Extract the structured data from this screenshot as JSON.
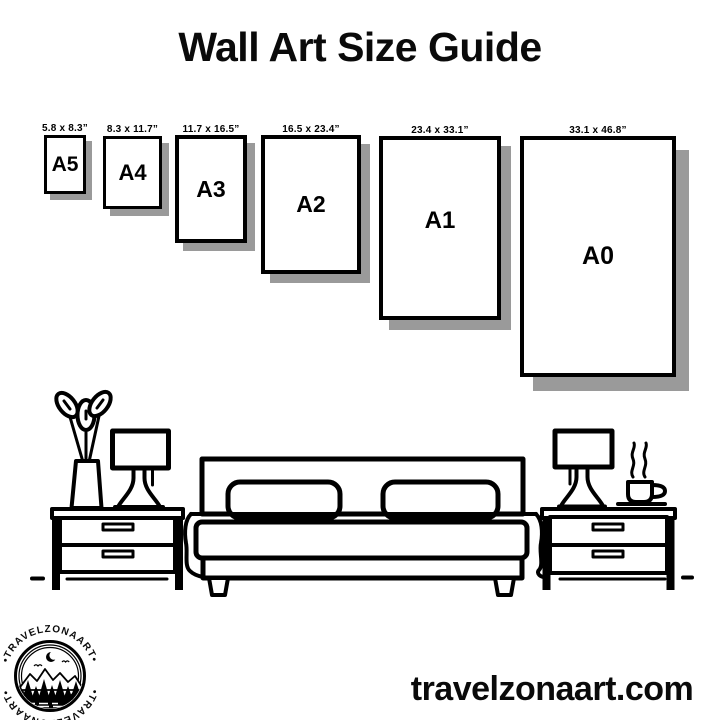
{
  "title": "Wall Art Size Guide",
  "frames": [
    {
      "name": "A5",
      "size": "5.8 x 8.3”"
    },
    {
      "name": "A4",
      "size": "8.3 x 11.7”"
    },
    {
      "name": "A3",
      "size": "11.7 x 16.5”"
    },
    {
      "name": "A2",
      "size": "16.5 x 23.4”"
    },
    {
      "name": "A1",
      "size": "23.4 x 33.1”"
    },
    {
      "name": "A0",
      "size": "33.1 x 46.8”"
    }
  ],
  "logo": {
    "brand": "TRAVELZONAART",
    "arc_text_top": "•TRAVELZONAART•",
    "arc_text_bottom": "•TRAVELZONAART•"
  },
  "footer": {
    "website": "travelzonaart.com"
  },
  "colors": {
    "ink": "#000000",
    "frame_shadow": "#9a9a9a",
    "background": "#ffffff"
  }
}
